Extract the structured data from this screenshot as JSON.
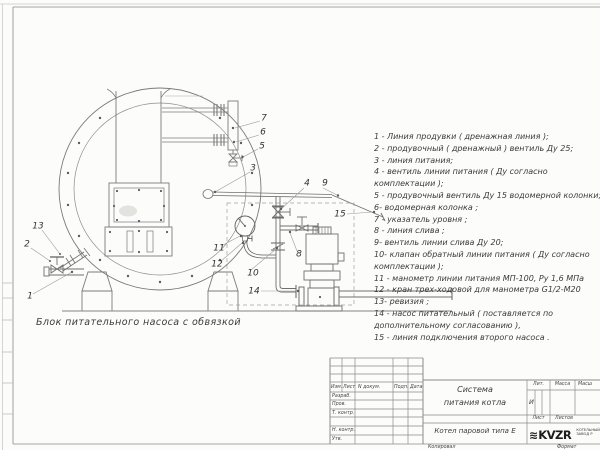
{
  "legend": {
    "lines": [
      "1 -  Линия продувки ( дренажная линия );",
      "2 -  продувочный ( дренажный ) вентиль Ду 25;",
      "3 -  линия питания;",
      "4 -  вентиль линии питания ( Ду согласно",
      "комплектации );",
      "5 -  продувочный вентиль Ду 15 водомерной колонки;",
      "6-  водомерная колонка ;",
      "7 -  указатель уровня ;",
      "8 -  линия слива ;",
      "9-  вентиль линии слива Ду 20;",
      "10-  клапан обратный линии питания ( Ду согласно",
      "комплектации );",
      "11 -  манометр линии питания МП-100, Ру 1,6 МПа",
      "12 -  кран трех-ходовой для манометра  G1/2-М20",
      "13-  ревизия ;",
      "14 -  насос питательный ( поставляется по",
      "дополнительному согласованию ),",
      "15 -  линия подключения второго насоса ."
    ]
  },
  "diagram": {
    "caption": "Блок питательного насоса с обвязкой",
    "callouts": [
      {
        "n": "1",
        "x": 30,
        "y": 297
      },
      {
        "n": "2",
        "x": 27,
        "y": 245
      },
      {
        "n": "13",
        "x": 38,
        "y": 227
      },
      {
        "n": "3",
        "x": 253,
        "y": 169
      },
      {
        "n": "4",
        "x": 307,
        "y": 184
      },
      {
        "n": "9",
        "x": 325,
        "y": 184
      },
      {
        "n": "15",
        "x": 340,
        "y": 215
      },
      {
        "n": "5",
        "x": 262,
        "y": 147
      },
      {
        "n": "6",
        "x": 263,
        "y": 133
      },
      {
        "n": "7",
        "x": 264,
        "y": 119
      },
      {
        "n": "8",
        "x": 299,
        "y": 255
      },
      {
        "n": "10",
        "x": 253,
        "y": 274
      },
      {
        "n": "11",
        "x": 219,
        "y": 249
      },
      {
        "n": "12",
        "x": 217,
        "y": 265
      },
      {
        "n": "14",
        "x": 254,
        "y": 292
      }
    ]
  },
  "title_block": {
    "header_cols": [
      "Изм.",
      "Лист",
      "N докум.",
      "Подп.",
      "Дата"
    ],
    "sign_rows": [
      "Разраб.",
      "Пров.",
      "Т. контр.",
      "",
      "Н. контр.",
      "Утв."
    ],
    "title_line1": "Система",
    "title_line2": "питания котла",
    "product": "Котел паровой типа Е",
    "lit_header": "Лит.",
    "massa_header": "Масса",
    "masshtab_header": "Масш",
    "lit_value": "И",
    "list_header": "Лист",
    "listov_header": "Листов",
    "logo": {
      "glyph": "≋",
      "text": "KVZR",
      "caption1": "КОТЕЛЬНЫЙ",
      "caption2": "ЗАВОД Р"
    },
    "kopiroval": "Копировал",
    "format_label": "Формат"
  }
}
